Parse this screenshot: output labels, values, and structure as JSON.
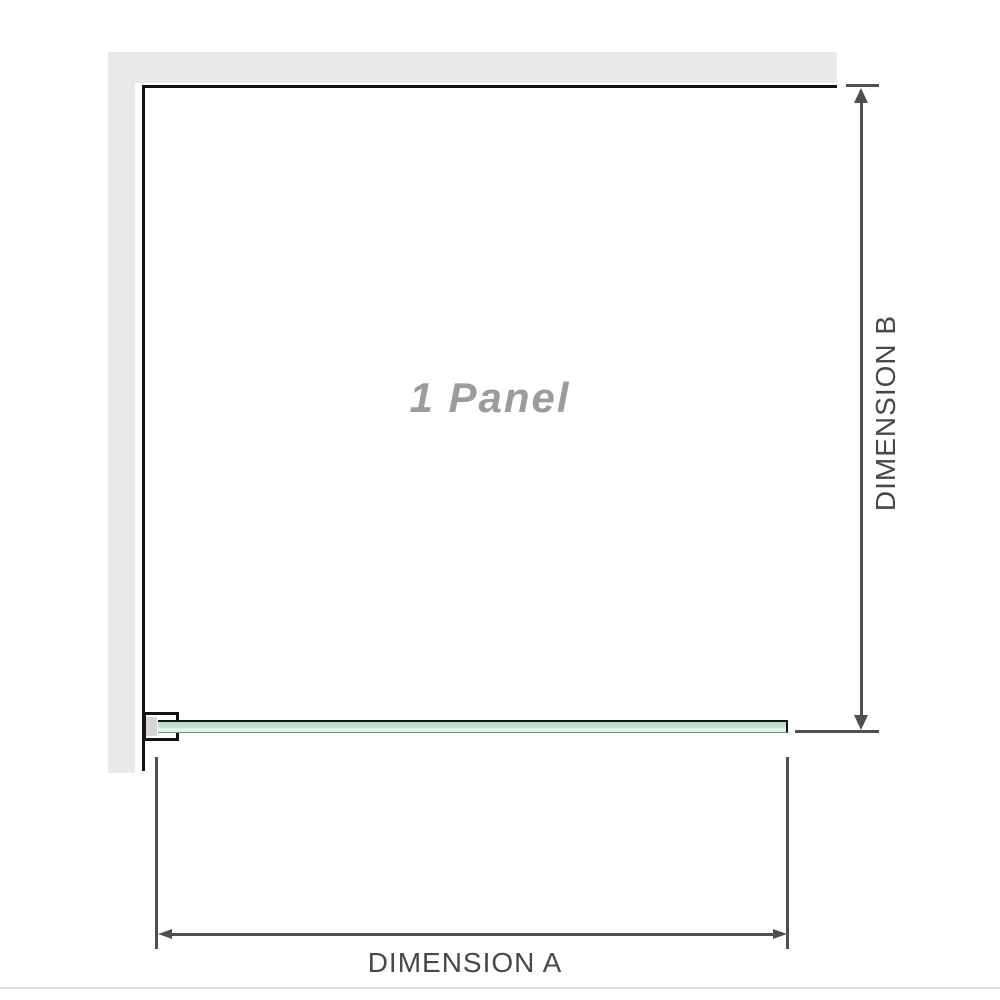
{
  "diagram": {
    "panel_label": "1 Panel",
    "dimension_a": {
      "label": "DIMENSION A"
    },
    "dimension_b": {
      "label": "DIMENSION B"
    }
  },
  "icons": {
    "dimension_b_up_arrow": "triangle-up",
    "dimension_b_down_arrow": "triangle-down",
    "dimension_a_left_arrow": "triangle-left",
    "dimension_a_right_arrow": "triangle-right"
  },
  "colors": {
    "wall": "#e9e9e9",
    "outline": "#141414",
    "dimension": "#4f4f4f",
    "label_text": "#46484a",
    "panel_text": "#9c9c9c",
    "glass_top": "#b1dec4",
    "glass_highlight": "#eaf6f0",
    "glass_edge": "#6f9a83",
    "bracket_inner": "#d6d6d6",
    "divider": "#e1e1e1"
  }
}
